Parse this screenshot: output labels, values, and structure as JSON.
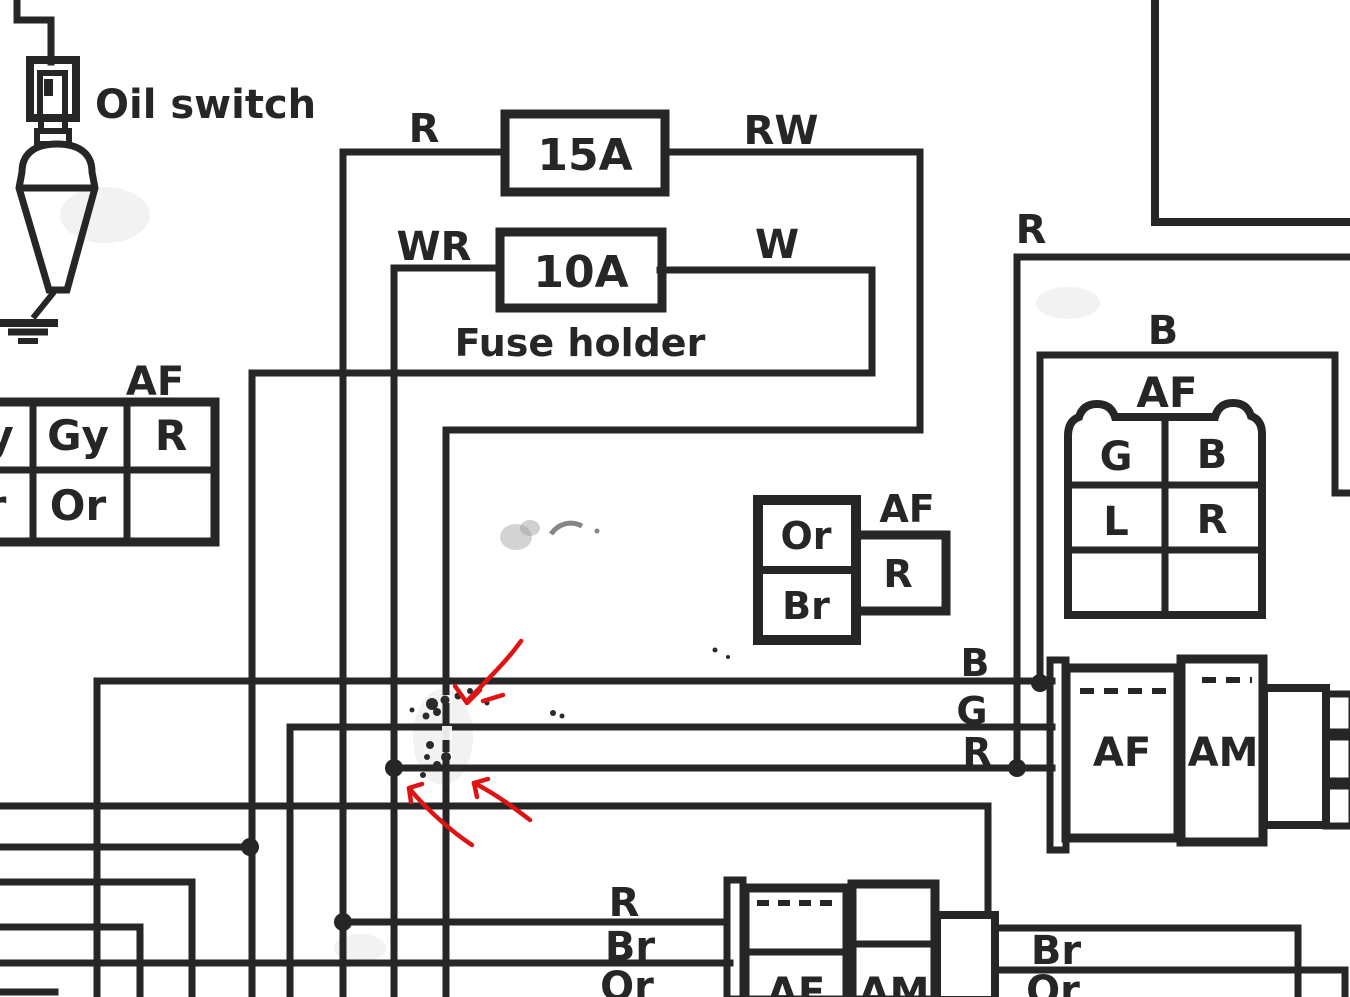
{
  "colors": {
    "ink": "#262626",
    "annotation": "#e01313",
    "paper": "#ffffff"
  },
  "oil_switch": {
    "label": "Oil switch"
  },
  "fuse_holder": {
    "caption": "Fuse holder",
    "fuse_top": {
      "rating": "15A",
      "wire_in": "R",
      "wire_out": "RW"
    },
    "fuse_bottom": {
      "rating": "10A",
      "wire_in": "WR",
      "wire_out": "W"
    }
  },
  "left_connector": {
    "label": "AF",
    "cells": {
      "row1": [
        "y",
        "Gy",
        "R"
      ],
      "row2": [
        "r",
        "Or",
        ""
      ]
    }
  },
  "mid_connector": {
    "label": "AF",
    "cell_top": "Or",
    "cell_bottom": "Br",
    "cell_right": "R"
  },
  "right_top": {
    "wire_r": "R",
    "wire_b": "B",
    "connector_label": "AF",
    "cells": {
      "row1": [
        "G",
        "B"
      ],
      "row2": [
        "L",
        "R"
      ],
      "row3": [
        "",
        ""
      ]
    }
  },
  "right_mid": {
    "wire_b": "B",
    "wire_g": "G",
    "wire_r": "R",
    "connector_left": "AF",
    "connector_right": "AM"
  },
  "bottom": {
    "wire_r": "R",
    "wire_br": "Br",
    "wire_or": "Or",
    "connector_left": "AF",
    "connector_right": "AM",
    "out_wire_br": "Br",
    "out_wire_or": "Or"
  },
  "annotations": {
    "arrow_count": 3,
    "arrow_color": "#e01313"
  }
}
